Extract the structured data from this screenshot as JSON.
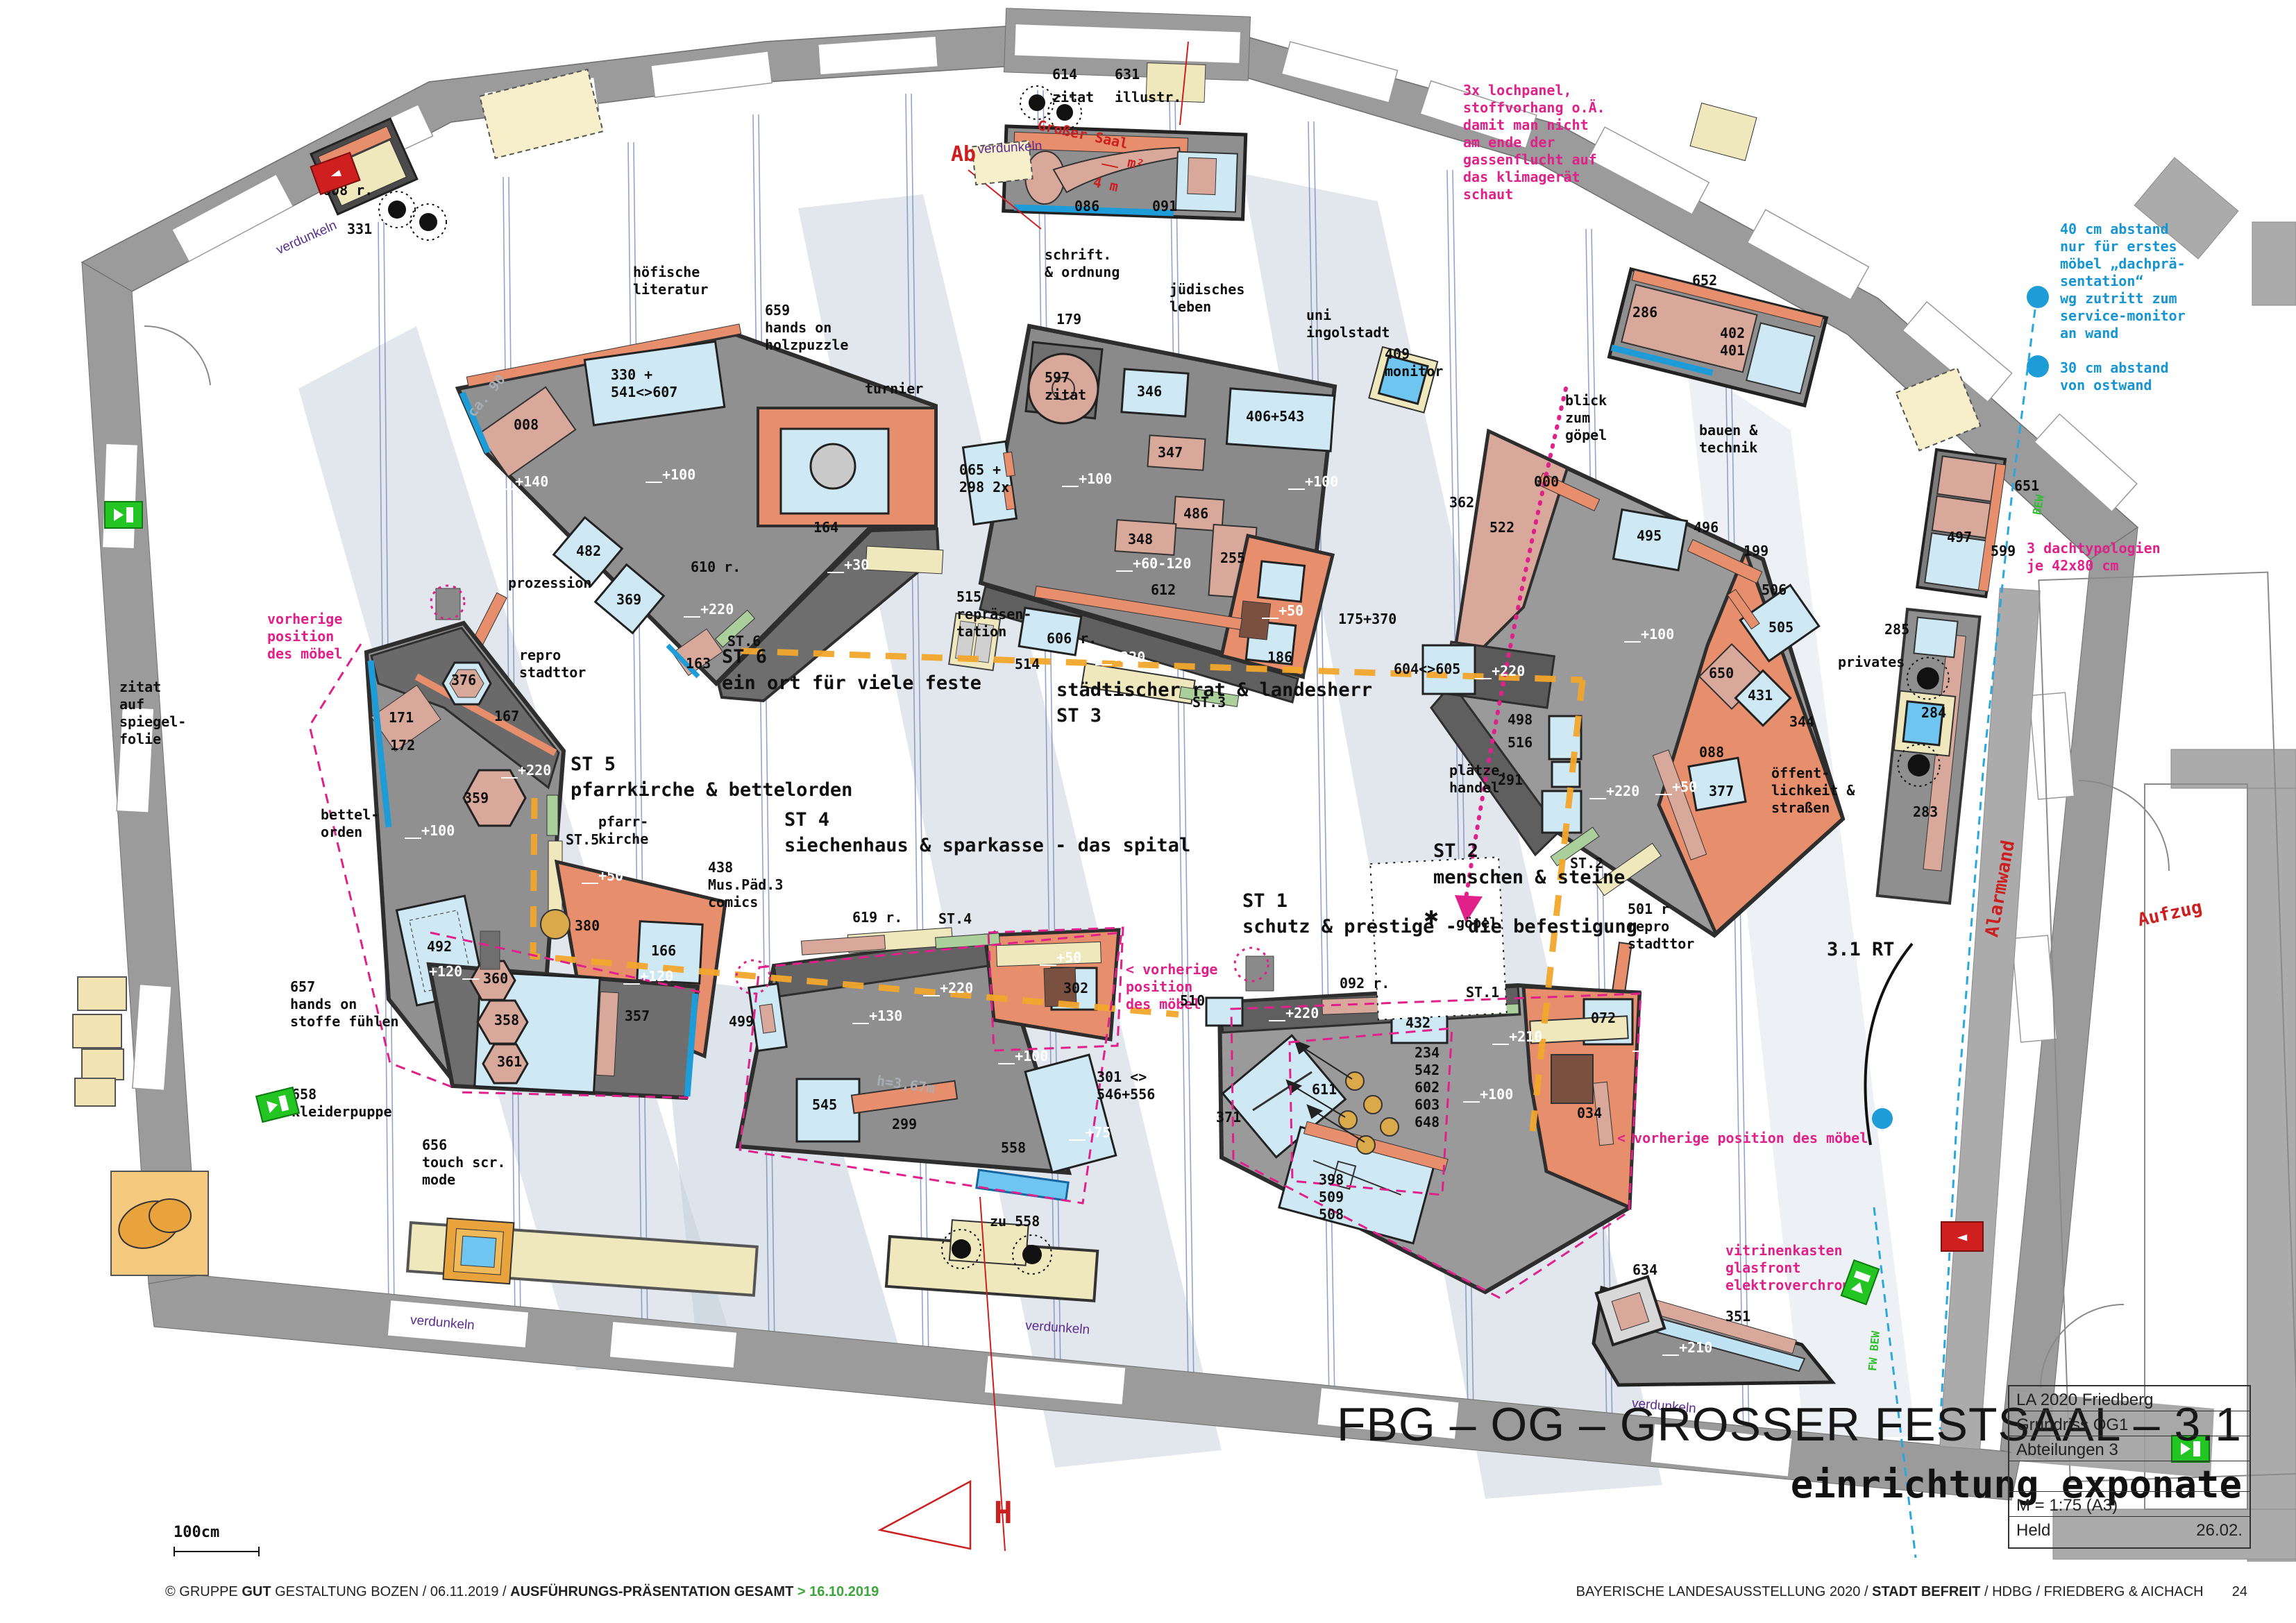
{
  "hdr": {
    "n614": "614",
    "z614": "zitat",
    "n631": "631",
    "z631": "illustr.",
    "n086": "086",
    "n091": "091",
    "ab": "Ab",
    "saal1": "Großer Saal",
    "saal2": "__ m²",
    "saal3": "4 m"
  },
  "notes": {
    "lochpanel": "3x lochpanel,\nstoffvorhang o.Ä.\ndamit man nicht\nam ende der\ngassenflucht auf\ndas klimagerät\nschaut",
    "abstand40": "40 cm abstand\nnur für erstes\nmöbel „dachprä-\nsentation“\nwg zutritt zum\nservice-monitor\nan wand",
    "abstand30": "30 cm abstand\nvon ostwand",
    "dach": "3 dachtypologien\nje 42x80 cm",
    "vitrine": "vitrinenkasten\nglasfront\nelektroverchromt",
    "prev_left": "vorherige\nposition\ndes möbel",
    "prev_mid": "< vorherige\nposition\ndes möbel",
    "prev_bottom": "< vorherige position des möbel"
  },
  "st6": {
    "head": "ST 6",
    "sub": "ein ort für viele feste",
    "n608": "608 r.",
    "n331": "331",
    "hoefische": "höfische\nliteratur",
    "holz": "659\nhands on\nholzpuzzle",
    "turnier": "turnier",
    "n330": "330 +\n541<>607",
    "n008": "008",
    "h140": "__+140",
    "h100": "__+100",
    "n482": "482",
    "n369": "369",
    "n610": "610 r.",
    "h30": "__+30",
    "h220": "__+220",
    "n164": "164",
    "st6s": "ST.6",
    "n163": "163",
    "prozession": "prozession",
    "repro": "repro\nstadttor",
    "ca90": "ca. 90"
  },
  "st5": {
    "head": "ST 5",
    "sub": "pfarrkirche & bettelorden",
    "zitat": "zitat\nauf\nspiegel-\nfolie",
    "bettel": "bettel-\norden",
    "n376": "376",
    "n171": "171",
    "n172": "172",
    "n167": "167",
    "n359": "359",
    "h220": "__+220",
    "h100": "__+100",
    "st5s": "ST.5",
    "n492": "492",
    "pfarr": "pfarr-\nkirche",
    "h50": "__+50",
    "n166": "166",
    "n380": "380"
  },
  "md": {
    "n657": "657\nhands on\nstoffe fühlen",
    "n658": "658\nkleiderpuppe",
    "n656": "656\ntouch scr.\nmode",
    "n360": "360",
    "n358": "358",
    "n361": "361",
    "n357": "357",
    "h120a": "+120__",
    "h120b": "__+120",
    "h367": "h=3,67m"
  },
  "st4": {
    "head": "ST 4",
    "sub": "siechenhaus & sparkasse - das spital",
    "comics": "438\nMus.Päd.3\ncomics",
    "n619": "619 r.",
    "st4s": "ST.4",
    "n302": "302",
    "h50": "__+50",
    "n499": "499",
    "h130": "__+130",
    "h220": "__+220",
    "h100": "__+100",
    "n545": "545",
    "n299": "299",
    "n301": "301 <>\n546+556",
    "h75": "__+75",
    "n558": "558",
    "zu558": "zu 558"
  },
  "st3": {
    "head": "städtischer rat & landesherr",
    "head2": "ST 3",
    "schrift": "schrift.\n& ordnung",
    "juedisch": "jüdisches\nleben",
    "uni": "uni\ningolstadt",
    "monitor": "409\nmonitor",
    "n179": "179",
    "n597": "597\nzitat",
    "n346": "346",
    "n406": "406+543",
    "n347": "347",
    "h100a": "__+100",
    "h100b": "__+100",
    "n065": "065 +\n298 2x",
    "n486": "486",
    "n348": "348",
    "n255": "255",
    "h60": "__+60-120",
    "n612": "612",
    "h50": "__+50",
    "n515": "515\nrepräsen-\ntation",
    "n514": "514",
    "n606": "606 r.",
    "h220": "__+220",
    "st3s": "ST.3",
    "n186": "186",
    "n175": "175+370"
  },
  "st2": {
    "head": "ST 2",
    "sub": "menschen & steine",
    "blick": "blick\nzum\ngöpel",
    "bauen": "bauen &\ntechnik",
    "n362": "362",
    "n522": "522",
    "n000": "000",
    "n495": "495",
    "n496": "496",
    "n199": "199",
    "n506": "506",
    "n505": "505",
    "n650": "650",
    "n431": "431",
    "n344": "344",
    "n088": "088",
    "h100": "__+100",
    "h220a": "__+220",
    "n604": "604<>605",
    "n498": "498",
    "n516": "516",
    "n291": "291",
    "plaetze": "plätze,\nhandel",
    "oeff": "öffent-\nlichkeit &\nstraßen",
    "privates": "privates",
    "st2s": "ST.2",
    "h220b": "__+220",
    "h50": "__+50",
    "n377": "377",
    "n501": "501 r\nrepro\nstadttor",
    "rt": "3.1 RT"
  },
  "st1": {
    "head": "ST 1",
    "sub": "schutz & prestige - die befestigung",
    "ast": "✱",
    "goepel": "göpel",
    "n092": "092 r.",
    "st1s": "ST.1",
    "n432": "432",
    "n072": "072",
    "h220": "__+220",
    "h210": "__+210",
    "h50": "__+50",
    "nums": "234\n542\n602\n603\n648",
    "n611": "611",
    "h100": "__+100",
    "n034": "034",
    "n371": "371",
    "n398": "398\n509\n508",
    "n510": "510"
  },
  "rt": {
    "n652": "652",
    "n286": "286",
    "n402": "402\n401",
    "n651": "651",
    "n497": "497",
    "n599": "599",
    "n285": "285",
    "n284": "284",
    "n283": "283",
    "alarmwand": "Alarmwand",
    "aufzug": "Aufzug",
    "n634": "634",
    "n351": "351",
    "h210": "__+210",
    "bew": "BEW",
    "fwbew": "FW BEW"
  },
  "msc": {
    "verdunkeln": "verdunkeln",
    "h": "H",
    "scale": "100cm"
  },
  "tb": {
    "l1": "LA 2020 Friedberg",
    "l2": "Grundriss OG1",
    "l3": "Abteilungen 3",
    "scale": "M = 1:75 (A3)",
    "author": "Held",
    "date": "26.02."
  },
  "titles": {
    "big": "FBG – OG – GROSSER FESTSAAL – 3.1",
    "sub": "einrichtung exponate"
  },
  "ft": {
    "c1": "© GRUPPE ",
    "b1": "GUT",
    "c2": " GESTALTUNG BOZEN",
    "s1": "/",
    "d1": "06.11.2019",
    "s2": "/",
    "b2": "AUSFÜHRUNGS-PRÄSENTATION GESAMT",
    "grn": "> 16.10.2019",
    "r1": "BAYERISCHE LANDESAUSSTELLUNG 2020",
    "s3": "/",
    "rb": "STADT BEFREIT",
    "s4": "/",
    "r2": "HDBG",
    "s5": "/",
    "r3": "FRIEDBERG & AICHACH",
    "page": "24"
  },
  "colors": {
    "accent_pink": "#e0218a",
    "accent_cyan": "#1e9cd7",
    "route_orange": "#f2a62c",
    "wall": "#9b9b9b",
    "salmon": "#e78f6c",
    "rose": "#d8a99a",
    "lightblue": "#cfe9f4",
    "cream": "#efe8bd",
    "green_strip": "#aacf9a",
    "exit_green": "#22c522",
    "sign_red": "#cf1f1f"
  }
}
